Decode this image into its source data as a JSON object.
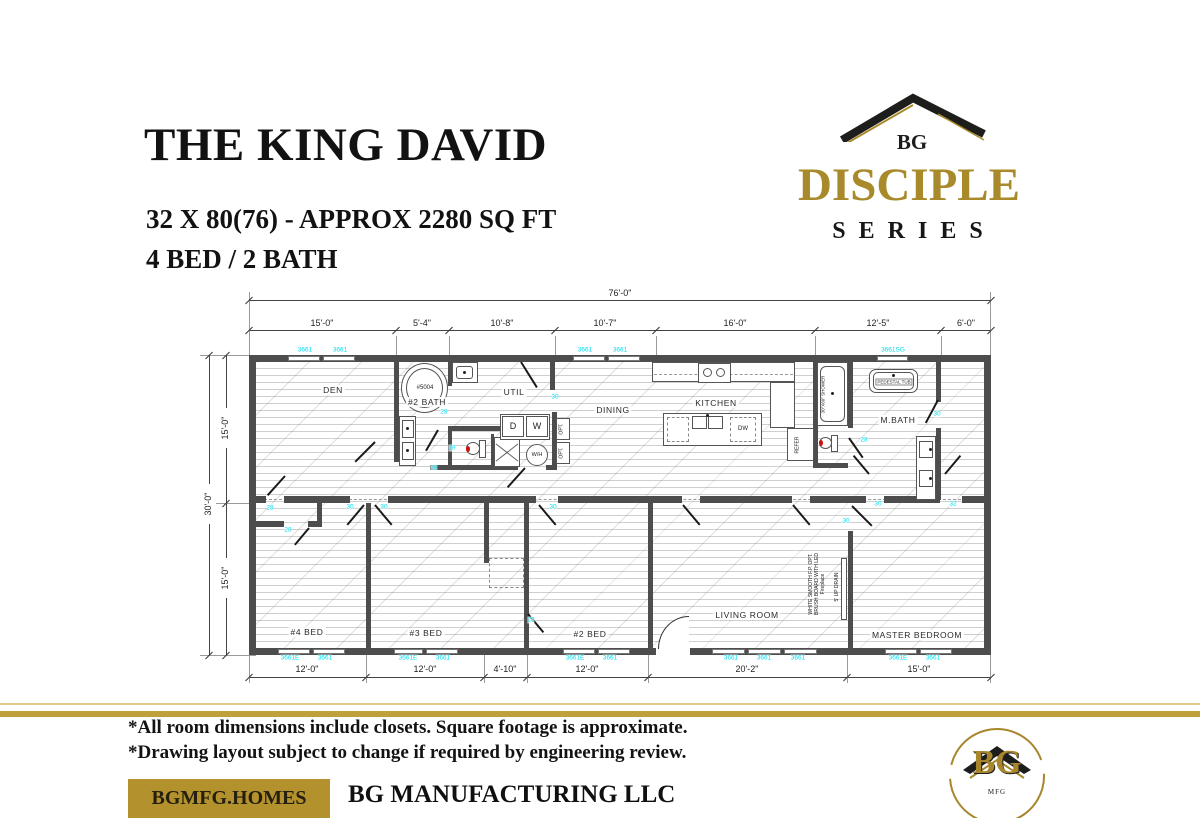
{
  "header": {
    "title": "THE KING DAVID",
    "subtitle": "32 X 80(76) - APPROX 2280 SQ FT",
    "beds_baths": "4 BED / 2 BATH"
  },
  "brand": {
    "monogram": "BG",
    "series_name": "DISCIPLE",
    "series_word": "SERIES",
    "gold": "#a98a2b",
    "dark": "#1d1d1b"
  },
  "plan": {
    "total_width_dim": {
      "t": "76'-0\"",
      "x": 620,
      "y": 293
    },
    "top_dims": [
      {
        "t": "15'-0\"",
        "x": 322,
        "y": 323
      },
      {
        "t": "5'-4\"",
        "x": 422,
        "y": 323
      },
      {
        "t": "10'-8\"",
        "x": 502,
        "y": 323
      },
      {
        "t": "10'-7\"",
        "x": 605,
        "y": 323
      },
      {
        "t": "16'-0\"",
        "x": 735,
        "y": 323
      },
      {
        "t": "12'-5\"",
        "x": 878,
        "y": 323
      },
      {
        "t": "6'-0\"",
        "x": 966,
        "y": 323
      }
    ],
    "bottom_dims": [
      {
        "t": "12'-0\"",
        "x": 307,
        "y": 669
      },
      {
        "t": "12'-0\"",
        "x": 425,
        "y": 669
      },
      {
        "t": "4'-10\"",
        "x": 505,
        "y": 669
      },
      {
        "t": "12'-0\"",
        "x": 587,
        "y": 669
      },
      {
        "t": "20'-2\"",
        "x": 747,
        "y": 669
      },
      {
        "t": "15'-0\"",
        "x": 919,
        "y": 669
      }
    ],
    "left_dims": {
      "total": "30'-0\"",
      "upper": "15'-0\"",
      "lower": "15'-0\""
    },
    "room_labels": [
      {
        "t": "DEN",
        "x": 333,
        "y": 390
      },
      {
        "t": "#2 BATH",
        "x": 427,
        "y": 402
      },
      {
        "t": "UTIL",
        "x": 514,
        "y": 392
      },
      {
        "t": "DINING",
        "x": 613,
        "y": 410
      },
      {
        "t": "KITCHEN",
        "x": 716,
        "y": 403
      },
      {
        "t": "M.BATH",
        "x": 898,
        "y": 420
      },
      {
        "t": "#4 BED",
        "x": 307,
        "y": 632
      },
      {
        "t": "#3 BED",
        "x": 426,
        "y": 633
      },
      {
        "t": "#2 BED",
        "x": 590,
        "y": 634
      },
      {
        "t": "LIVING ROOM",
        "x": 747,
        "y": 615
      },
      {
        "t": "MASTER BEDROOM",
        "x": 917,
        "y": 635
      }
    ],
    "window_labels": [
      {
        "t": "3661",
        "x": 305,
        "y": 350
      },
      {
        "t": "3661",
        "x": 340,
        "y": 350
      },
      {
        "t": "3661",
        "x": 585,
        "y": 350
      },
      {
        "t": "3661",
        "x": 620,
        "y": 350
      },
      {
        "t": "3661SG",
        "x": 893,
        "y": 350
      },
      {
        "t": "3661E",
        "x": 290,
        "y": 658
      },
      {
        "t": "3661",
        "x": 325,
        "y": 658
      },
      {
        "t": "3661E",
        "x": 408,
        "y": 658
      },
      {
        "t": "3661",
        "x": 443,
        "y": 658
      },
      {
        "t": "3661E",
        "x": 575,
        "y": 658
      },
      {
        "t": "3661",
        "x": 610,
        "y": 658
      },
      {
        "t": "3661",
        "x": 731,
        "y": 658
      },
      {
        "t": "3661",
        "x": 764,
        "y": 658
      },
      {
        "t": "3661",
        "x": 798,
        "y": 658
      },
      {
        "t": "3661E",
        "x": 898,
        "y": 658
      },
      {
        "t": "3661",
        "x": 933,
        "y": 658
      }
    ],
    "door_labels": [
      {
        "t": "30",
        "x": 555,
        "y": 397
      },
      {
        "t": "28",
        "x": 444,
        "y": 412
      },
      {
        "t": "28",
        "x": 452,
        "y": 448
      },
      {
        "t": "28",
        "x": 434,
        "y": 468
      },
      {
        "t": "28",
        "x": 270,
        "y": 508
      },
      {
        "t": "30",
        "x": 350,
        "y": 507
      },
      {
        "t": "30",
        "x": 384,
        "y": 507
      },
      {
        "t": "30",
        "x": 553,
        "y": 507
      },
      {
        "t": "28",
        "x": 288,
        "y": 530
      },
      {
        "t": "28",
        "x": 531,
        "y": 620
      },
      {
        "t": "30",
        "x": 846,
        "y": 521
      },
      {
        "t": "28",
        "x": 864,
        "y": 440
      },
      {
        "t": "30",
        "x": 937,
        "y": 414
      },
      {
        "t": "30",
        "x": 878,
        "y": 504
      },
      {
        "t": "32",
        "x": 953,
        "y": 504
      }
    ],
    "fixtures": {
      "tub_model": "#5004",
      "dryer": "D",
      "washer": "W",
      "water_heater": "W/H",
      "dishwasher": "DW",
      "opt": "OPT.",
      "refrigerator": "REFER",
      "pedestal_tub": "PEDESTAL TUB",
      "shower": "30\"X60\" SHOWER"
    },
    "annotations": {
      "fireplace": "WHITE SMOOTH F.P. OPT. BRUSH BOARD WITH LED Fireplace",
      "drain": "5' UP DRAIN"
    }
  },
  "footer": {
    "note1": "*All room dimensions include closets. Square footage is approximate.",
    "note2": "*Drawing layout subject to change if required by engineering review.",
    "website": "BGMFG.HOMES",
    "company": "BG MANUFACTURING LLC",
    "seal_monogram": "BG",
    "seal_sub": "MFG",
    "gold_band": "#bfa03b",
    "gold_box": "#b3922e"
  }
}
